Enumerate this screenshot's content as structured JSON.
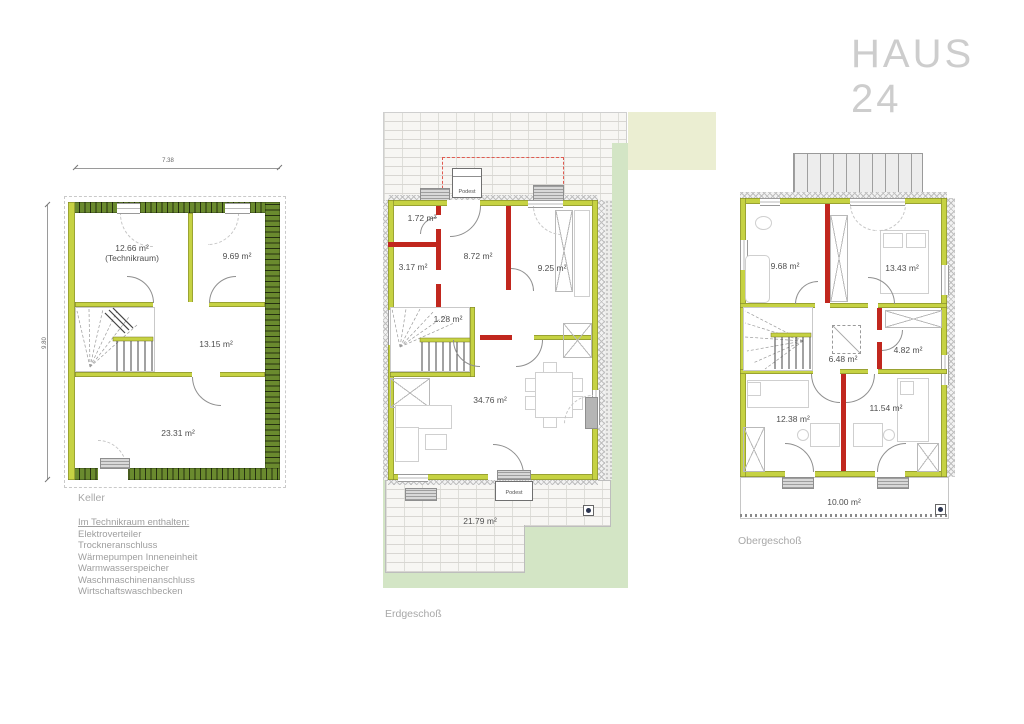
{
  "title": "HAUS 24",
  "keller": {
    "label": "Keller",
    "dim_width": "7.38",
    "dim_height": "9.80",
    "room_technik_line1": "12.66 m²",
    "room_technik_line2": "(Technikraum)",
    "room_hobby": "9.69 m²",
    "room_mitte": "13.15 m²",
    "room_gross": "23.31 m²"
  },
  "erdgeschoss": {
    "label": "Erdgeschoß",
    "podest_top": "Podest",
    "podest_bottom": "Podest",
    "room_wc": "1.72 m²",
    "room_diele": "8.72 m²",
    "room_abstell": "3.17 m²",
    "room_kueche": "9.25 m²",
    "room_treppe": "1.28 m²",
    "room_wohnen": "34.76 m²",
    "room_terrasse": "21.79 m²"
  },
  "obergeschoss": {
    "label": "Obergeschoß",
    "room_bad": "9.68 m²",
    "room_schlafen": "13.43 m²",
    "room_flur": "6.48 m²",
    "room_abstell": "4.82 m²",
    "room_kind1": "12.38 m²",
    "room_kind2": "11.54 m²",
    "room_balkon": "10.00 m²"
  },
  "note": {
    "heading": "Im Technikraum enthalten:",
    "items": [
      "Elektroverteiler",
      "Trockneranschluss",
      "Wärmepumpen Inneneinheit",
      "Warmwasserspeicher",
      "Waschmaschinenanschluss",
      "Wirtschaftswaschbecken"
    ]
  },
  "colors": {
    "wall_outer_keller": "#6a8a2e",
    "wall_lime": "#c6d243",
    "wall_red": "#c1271e",
    "lawn": "#d3e5c5",
    "pale_green": "#ebeed2",
    "title_gray": "#cdcdcd"
  }
}
